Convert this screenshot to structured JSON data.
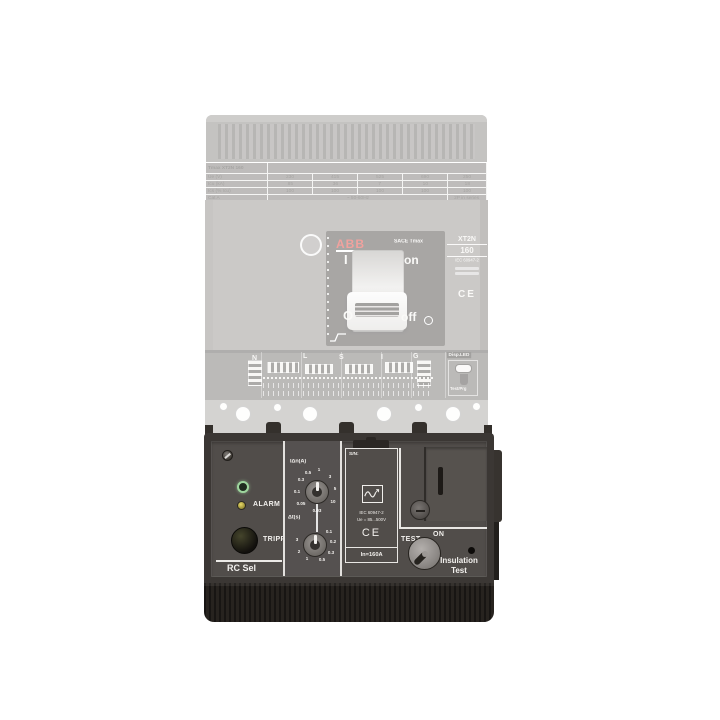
{
  "brand": {
    "logo": "ABB"
  },
  "breaker": {
    "table": {
      "title": "Tmax XT2N 160",
      "rows": [
        {
          "label": "Ue (V)",
          "values": [
            "230",
            "415",
            "525",
            "690",
            "250"
          ]
        },
        {
          "label": "Icu (kA)",
          "values": [
            "85",
            "36",
            "7",
            "10",
            "18"
          ]
        },
        {
          "label": "Ics (% Icu)",
          "values": [
            "100",
            "100",
            "100",
            "100",
            "100"
          ]
        }
      ],
      "footer": {
        "label": "Cat A",
        "ac": "~ 50-60Hz",
        "dc": "2P in series"
      }
    },
    "face": {
      "series": "SACE Tmax",
      "i": "I",
      "on": "on",
      "o": "O",
      "off": "off"
    },
    "side_label": {
      "model": "XT2N",
      "rating": "160",
      "standard": "IEC 60947-2",
      "ce": "CE"
    },
    "strip": {
      "n": "N",
      "l": "L",
      "s": "S",
      "i": "I",
      "g": "G",
      "disp": "Disp.LED",
      "testprg": "Test/Prg"
    }
  },
  "module": {
    "name": "RC Sel",
    "alarm": "ALARM",
    "tripped": "TRIPPED",
    "dial_idn": {
      "label": "IΔn(A)",
      "values": [
        "0.03",
        "0.05",
        "0.1",
        "0.3",
        "0.5",
        "1",
        "3",
        "5",
        "10"
      ]
    },
    "dial_dt": {
      "label": "Δt(s)",
      "values": [
        "0.1",
        "0.2",
        "0.3",
        "0.5",
        "1",
        "2",
        "3"
      ]
    },
    "sn": "S/N:",
    "standard": "IEC 60947-2",
    "voltage": "Ue = 85...500V",
    "ce": "CE",
    "in_rating": "In=160A",
    "test": "TEST",
    "on": "ON",
    "insulation": [
      "Insulation",
      "Test"
    ]
  },
  "colors": {
    "abb_red": "#e2332b",
    "module_face": "#514d4a",
    "led_green": "#9ed69e",
    "led_amber": "#d9c94f",
    "background": "#ffffff"
  }
}
